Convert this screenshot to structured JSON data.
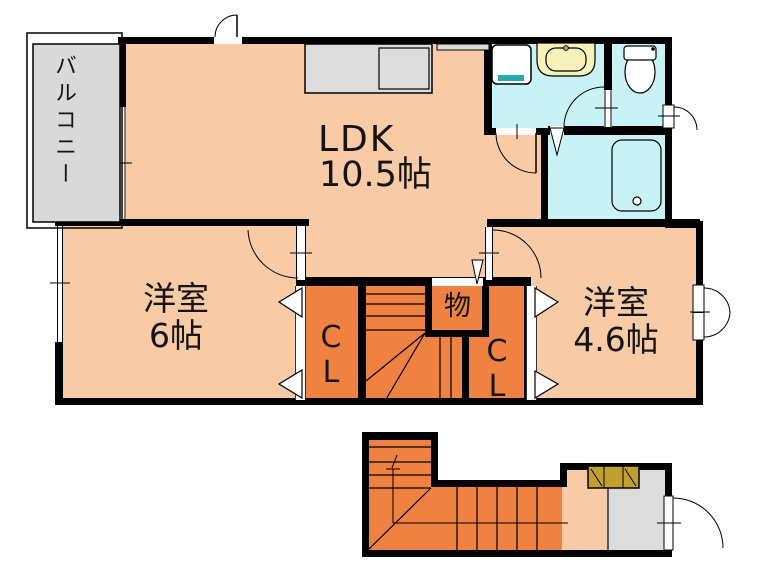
{
  "plan": {
    "type": "apartment-floor-plan",
    "labels": {
      "balcony": "バルコニー",
      "ldk": {
        "line1": "LDK",
        "line2": "10.5帖"
      },
      "room_west_6": {
        "line1": "洋室",
        "line2": "6帖"
      },
      "room_west_46": {
        "line1": "洋室",
        "line2": "4.6帖"
      },
      "closet_left": "C\nL",
      "closet_right": "C\nL",
      "storage": "物"
    },
    "palette": {
      "wall": "#000000",
      "room_peach": "#f8cba6",
      "core_orange": "#ef8142",
      "wet_cyan": "#c9f2f7",
      "vanity_yellow": "#f7f3b8",
      "counter_gray": "#dcdcdc",
      "balcony_gray": "#d9d9d9",
      "washer_teal": "#2aa9ad",
      "shoe_cabinet_olive": "#bfa02f"
    },
    "icons": {
      "kitchen-counter-icon": "gray counter with sink rectangle",
      "washing-machine-icon": "rounded square with teal strip",
      "sink-vanity-icon": "yellow vanity with oval basin",
      "toilet-icon": "tank and bowl",
      "bathtub-icon": "rounded rectangle with drain circle",
      "shoe-cabinet-icon": "olive box with hinged door marks",
      "stairs-icon": "tread lines with winders and walk line"
    }
  }
}
